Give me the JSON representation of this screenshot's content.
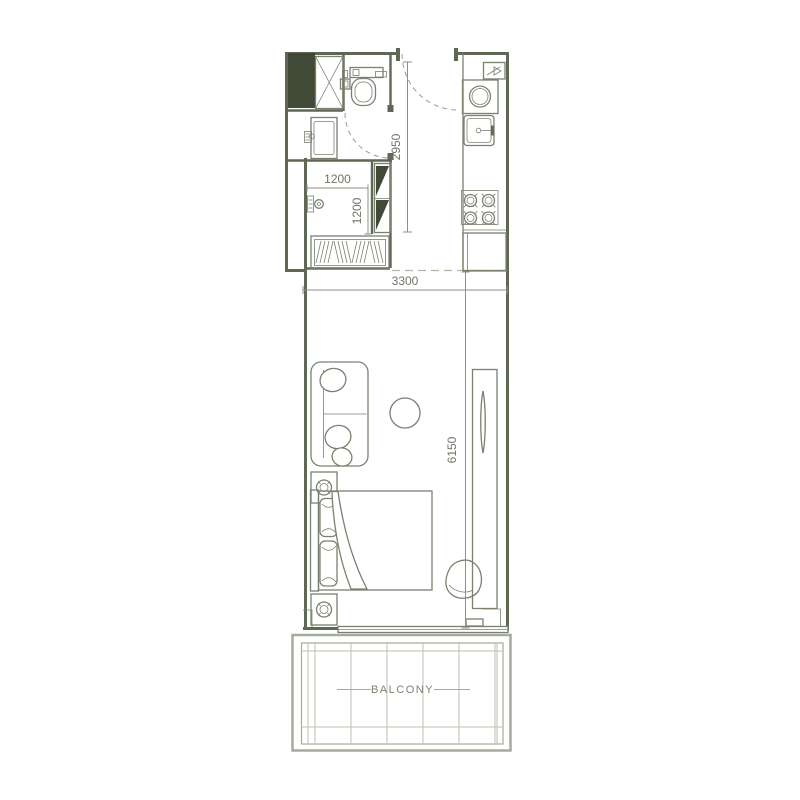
{
  "floor_plan": {
    "room_labels": {
      "balcony": "BALCONY"
    },
    "dimensions": {
      "hallway_length": "2950",
      "utility_width": "1200",
      "utility_depth": "1200",
      "living_width": "3300",
      "living_length": "6150"
    },
    "colors": {
      "background": "#ffffff",
      "wall_line": "#5f6755",
      "furniture_line": "#7a816f",
      "dark_fill": "#404a37",
      "dimension_text": "#6d7464",
      "dimension_line": "#8b9181",
      "door_dash": "#9aa08f",
      "break_dash": "#b1b6a7",
      "balcony_line": "#a6ab9c",
      "balcony_grid": "#bcc1b2",
      "label_text": "#7d8373"
    }
  }
}
